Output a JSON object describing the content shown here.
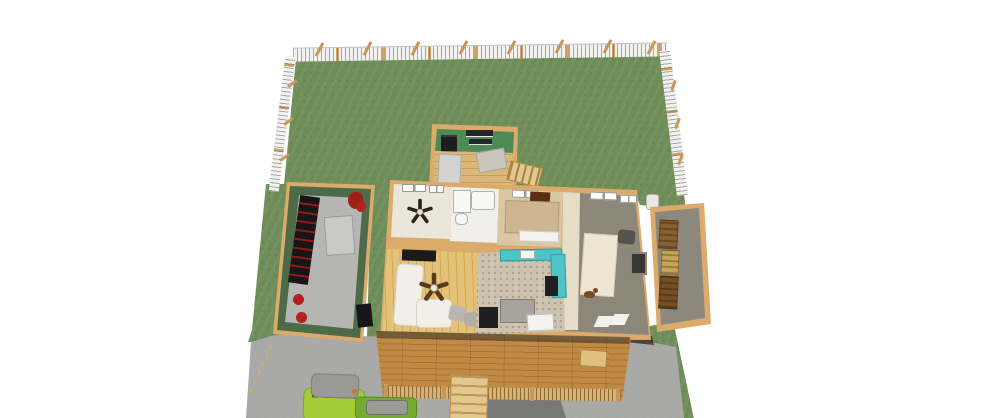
{
  "app": {
    "description": "3D aerial dollhouse rendering of a single-family house plan with fenced backyard, attached garage, interior rooms exposed from above, side wood-storage porch, front deck, driveway and two parked vehicles"
  },
  "regions": {
    "viewport": {
      "label": "3D plan view"
    },
    "backyard": {
      "label": "Fenced backyard lawn"
    },
    "fence": {
      "label": "White picket fence with leaning posts"
    },
    "garage": {
      "label": "Garage with tool bench, work table and red gear"
    },
    "utility_room": {
      "label": "Utility room with washer and wall shelves"
    },
    "mudroom": {
      "label": "Mudroom with closets"
    },
    "back_steps": {
      "label": "Back door steps"
    },
    "bedroom_fan": {
      "label": "Bedroom with ceiling fan"
    },
    "bathroom": {
      "label": "Bathroom with tub, shower and toilet"
    },
    "bedroom_bed": {
      "label": "Bedroom with bed and dark headboard"
    },
    "family_room": {
      "label": "Family room with area rug"
    },
    "living_room": {
      "label": "Living room with sectional sofa and ceiling fan"
    },
    "kitchen": {
      "label": "Kitchen with teal counters and appliances"
    },
    "side_porch": {
      "label": "Side porch with stacked firewood"
    },
    "front_porch": {
      "label": "Front porch deck with railing"
    },
    "porch_steps": {
      "label": "Front porch steps"
    },
    "walkway": {
      "label": "Front walkway"
    },
    "driveway": {
      "label": "Concrete driveway"
    },
    "truck": {
      "label": "Lime green pickup truck"
    },
    "car": {
      "label": "Green car"
    },
    "ac_unit": {
      "label": "Outdoor AC unit"
    },
    "dog": {
      "label": "Dog figure"
    }
  },
  "palette": {
    "page_bg": "#ffffff",
    "grass": "#6e8d58",
    "fence_white": "#f1f1ef",
    "fence_post": "#c89858",
    "wood_trim": "#dcab6c",
    "garage_wall_green": "#4d6a49",
    "garage_floor": "#b6b6b4",
    "driveway_concrete": "#a9a9a7",
    "walkway_gray": "#787876",
    "shadow_brown": "#3a342c",
    "utility_green": "#4e8a55",
    "mudroom_wood": "#dbb878",
    "closet_gray": "#d2d2ce",
    "closet_gray2": "#cac6be",
    "floor_cream": "#ebe6da",
    "floor_bath": "#f0efe9",
    "carpet_tan": "#d8c8a2",
    "floor_wood": "#e4c276",
    "kitchen_tile": "#cdc3b0",
    "floor_gray": "#8d8779",
    "hall_cream": "#e5ddc8",
    "rug_cream": "#eee6d2",
    "teal_counter": "#4fc3c7",
    "appliance_black": "#1f1f1f",
    "island_gray": "#a8a49c",
    "white_fixture": "#f8f8f5",
    "sofa_white": "#f1efe8",
    "chair_gray": "#b9b7b2",
    "chair_gray2": "#b0aeaa",
    "bed_tan": "#cdb691",
    "headboard_brown": "#5a3014",
    "dark_chair": "#57534c",
    "fireplace_dark": "#3a3632",
    "porch_wood": "#c08a45",
    "railing_tan": "#d8b070",
    "step_tan": "#e3c88c",
    "bench_tan": "#e0c080",
    "shed_floor": "#8d887e",
    "firewood_dark": "#774f26",
    "firewood_mid": "#8a6030",
    "firewood_light": "#c9a55a",
    "bench_black": "#161616",
    "table_gray": "#c9c9c5",
    "door_dark": "#15151a",
    "accent_red": "#b32020",
    "bag_red": "#a02018",
    "washer_black": "#1e1e22",
    "shelf_dark": "#23272b",
    "tv_black": "#1b1b1b",
    "truck_lime": "#a4cc35",
    "car_green": "#74aa30",
    "vehicle_roof_gray": "#9a9a96",
    "windshield_dark": "#44463e",
    "taillight_orange": "#d07818",
    "dog_brown": "#7a4a22",
    "sheet_white": "#f4f2ee",
    "ac_white": "#e8e8e6"
  }
}
